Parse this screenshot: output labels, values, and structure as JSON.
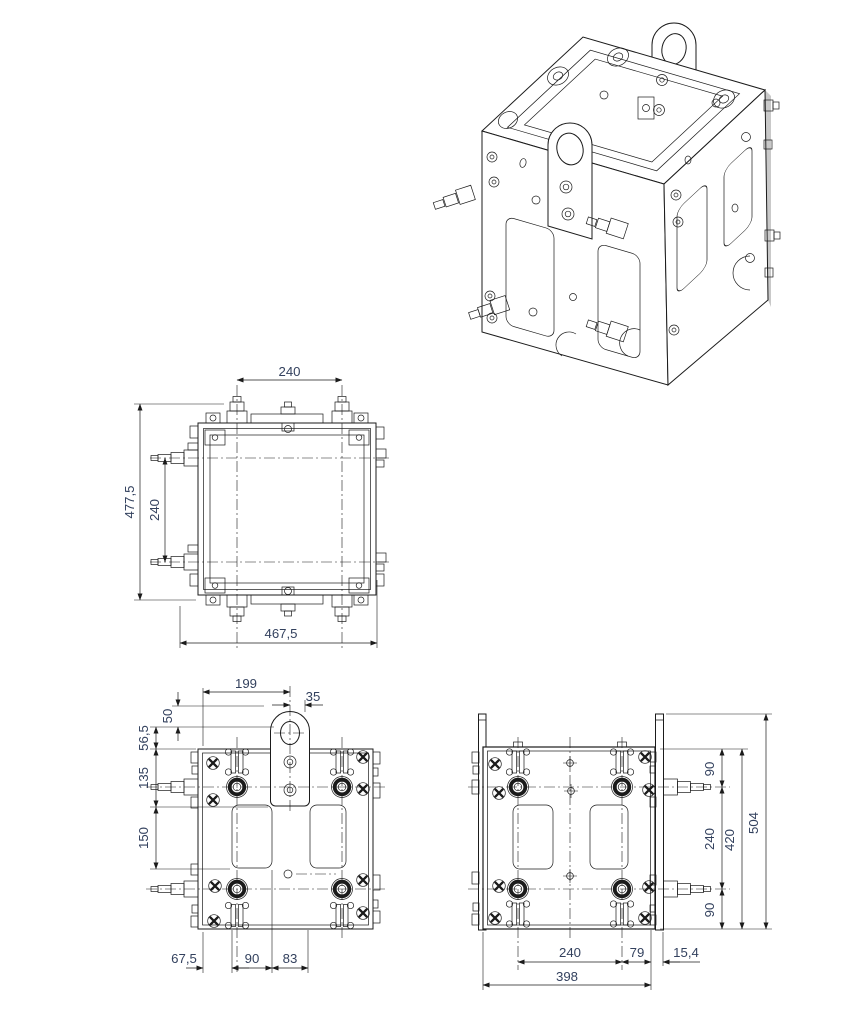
{
  "drawing": {
    "type": "technical-drawing",
    "views": [
      "isometric-view",
      "top-view",
      "front-view",
      "side-view"
    ],
    "colors": {
      "line": "#1b1b1b",
      "dimension_text": "#33415e",
      "background": "#ffffff",
      "edge_shade": "#c9c9c9"
    }
  },
  "dim": {
    "top": {
      "w240": "240",
      "h477": "477,5",
      "v240": "240",
      "w467": "467,5"
    },
    "front": {
      "d199": "199",
      "d35": "35",
      "d50": "50",
      "d56": "56,5",
      "d135": "135",
      "d150": "150",
      "d67": "67,5",
      "d90": "90",
      "d83": "83"
    },
    "side": {
      "t90": "90",
      "m240": "240",
      "b90": "90",
      "h420": "420",
      "h504": "504",
      "w240": "240",
      "w79": "79",
      "w15": "15,4",
      "w398": "398"
    }
  }
}
